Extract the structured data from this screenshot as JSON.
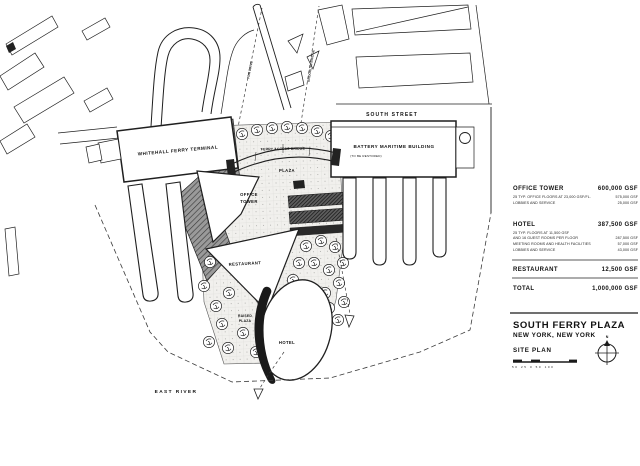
{
  "plan": {
    "streets": {
      "south_street": "SOUTH STREET",
      "east_river": "EAST RIVER"
    },
    "buildings": {
      "whitehall": "WHITEHALL FERRY TERMINAL",
      "bmb_line1": "BATTERY MARITIME BUILDING",
      "bmb_line2": "(TO BE RESTORED)",
      "office_line1": "OFFICE",
      "office_line2": "TOWER",
      "restaurant": "RESTAURANT",
      "hotel": "HOTEL"
    },
    "features": {
      "ferry_access_bridge": "FERRY ACCESS BRIDGE",
      "plaza": "PLAZA",
      "raised_line1": "RAISED",
      "raised_line2": "PLAZA",
      "sight_left": "FDR DRIVE",
      "sight_right": "BROOKLYN BRIDGE"
    }
  },
  "program": {
    "sections": [
      {
        "name": "OFFICE TOWER",
        "total": "600,000 GSF",
        "items": [
          {
            "label": "25 TYP. OFFICE FLOORS AT 23,000 GSF/FL.",
            "value": "575,000 GSF"
          },
          {
            "label": "LOBBIES AND SERVICE",
            "value": "25,000 GSF"
          }
        ]
      },
      {
        "name": "HOTEL",
        "total": "387,500 GSF",
        "items": [
          {
            "label": "25 TYP. FLOORS AT 11,500 GSF",
            "label2": "AND 16 GUEST ROOMS PER FLOOR",
            "value": "287,500 GSF"
          },
          {
            "label": "MEETING ROOMS AND HEALTH FACILITIES",
            "value": "57,000 GSF"
          },
          {
            "label": "LOBBIES AND SERVICE",
            "value": "43,000 GSF"
          }
        ]
      },
      {
        "name": "RESTAURANT",
        "total": "12,500 GSF",
        "items": []
      },
      {
        "name": "TOTAL",
        "total": "1,000,000 GSF",
        "items": []
      }
    ]
  },
  "title_block": {
    "project": "SOUTH FERRY PLAZA",
    "location": "NEW YORK, NEW YORK",
    "sheet": "SITE PLAN",
    "north": "N",
    "scale_ticks": "50 25 0 50 100"
  },
  "colors": {
    "ink": "#1f1f1f",
    "paper": "#ffffff",
    "poche_gray": "#8a8a8a",
    "dark": "#222222"
  }
}
